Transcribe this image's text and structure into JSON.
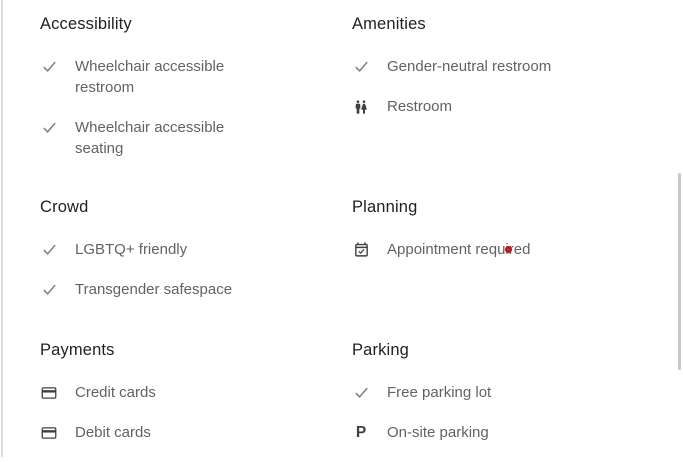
{
  "colors": {
    "heading_text": "#202124",
    "item_text": "#5f6368",
    "icon_dark": "#3c4043",
    "icon_check": "#7d8085",
    "red_dot": "#c52222",
    "scrollbar_thumb": "#c8c8c8",
    "panel_border": "#dcdcdc"
  },
  "icon_glyphs": {
    "parking-p": "P"
  },
  "sections": [
    {
      "title": "Accessibility",
      "items": [
        {
          "icon": "check",
          "lines": [
            "Wheelchair accessible",
            "restroom"
          ]
        },
        {
          "icon": "check",
          "lines": [
            "Wheelchair accessible",
            "seating"
          ]
        }
      ]
    },
    {
      "title": "Amenities",
      "items": [
        {
          "icon": "check",
          "lines": [
            "Gender-neutral restroom"
          ]
        },
        {
          "icon": "restroom",
          "lines": [
            "Restroom"
          ]
        }
      ]
    },
    {
      "title": "Crowd",
      "items": [
        {
          "icon": "check",
          "lines": [
            "LGBTQ+ friendly"
          ]
        },
        {
          "icon": "check",
          "lines": [
            "Transgender safespace"
          ]
        }
      ]
    },
    {
      "title": "Planning",
      "items": [
        {
          "icon": "calendar-check",
          "lines": [
            "Appointment required"
          ]
        }
      ]
    },
    {
      "title": "Payments",
      "items": [
        {
          "icon": "credit-card",
          "lines": [
            "Credit cards"
          ]
        },
        {
          "icon": "credit-card",
          "lines": [
            "Debit cards"
          ]
        }
      ]
    },
    {
      "title": "Parking",
      "items": [
        {
          "icon": "check",
          "lines": [
            "Free parking lot"
          ]
        },
        {
          "icon": "parking-p",
          "lines": [
            "On-site parking"
          ]
        }
      ]
    }
  ]
}
